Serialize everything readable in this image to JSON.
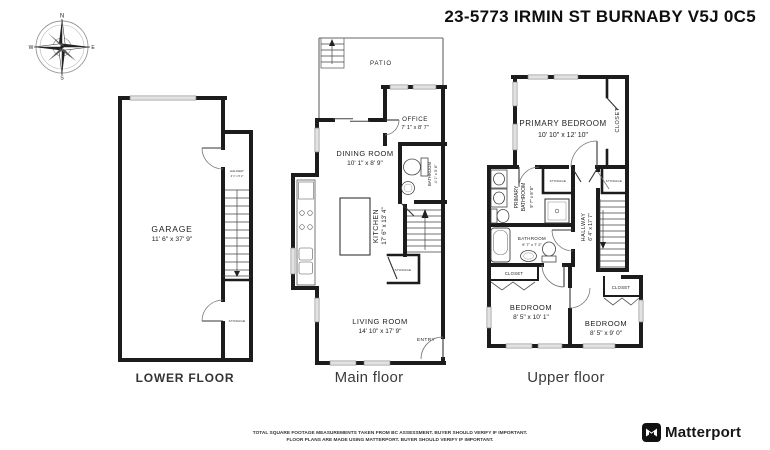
{
  "title": "23-5773 IRMIN ST BURNABY V5J 0C5",
  "compass": {
    "n": "N",
    "e": "E",
    "s": "S",
    "w": "W"
  },
  "floors": {
    "lower": {
      "caption": "LOWER FLOOR",
      "garage_name": "GARAGE",
      "garage_dims": "11' 6\" x 37' 9\"",
      "hall_name": "HALLWAY",
      "hall_dims": "3' 1\" x 5' 2\"",
      "storage_name": "STORAGE"
    },
    "main": {
      "caption": "Main floor",
      "patio": "PATIO",
      "office_name": "OFFICE",
      "office_dims": "7' 1\" x 8' 7\"",
      "dining_name": "DINING ROOM",
      "dining_dims": "10' 1\" x 8' 9\"",
      "kitchen_name": "KITCHEN",
      "kitchen_dims": "17' 6\" x 13' 4\"",
      "bath_name": "BATHROOM",
      "bath_dims": "4' 1\" x 5' 6\"",
      "living_name": "LIVING ROOM",
      "living_dims": "14' 10\" x 17' 9\"",
      "storage_name": "STORAGE",
      "entry": "ENTRY"
    },
    "upper": {
      "caption": "Upper floor",
      "primary_name": "PRIMARY BEDROOM",
      "primary_dims": "10' 10\" x 12' 10\"",
      "closet1": "CLOSET",
      "closet2": "CLOSET",
      "closet3": "CLOSET",
      "pbath_line1": "PRIMARY",
      "pbath_line2": "BATHROOM",
      "pbath_dims": "9' 7\" x 8' 5\"",
      "storage1": "STORAGE",
      "storage2": "STORAGE",
      "hall_name": "HALLWAY",
      "hall_dims": "6' 4\" x 17' 7\"",
      "bath_name": "BATHROOM",
      "bath_dims": "9' 7\" x 7' 2\"",
      "bed1_name": "BEDROOM",
      "bed1_dims": "8' 5\" x 10' 1\"",
      "bed2_name": "BEDROOM",
      "bed2_dims": "8' 5\" x 9' 0\""
    }
  },
  "footer": {
    "line1": "TOTAL SQUARE FOOTAGE MEASUREMENTS TAKEN FROM BC ASSESSMENT. BUYER SHOULD VERIFY IF IMPORTANT.",
    "line2": "FLOOR PLANS ARE MADE USING MATTERPORT. BUYER SHOULD VERIFY IF IMPORTANT.",
    "brand": "Matterport"
  }
}
